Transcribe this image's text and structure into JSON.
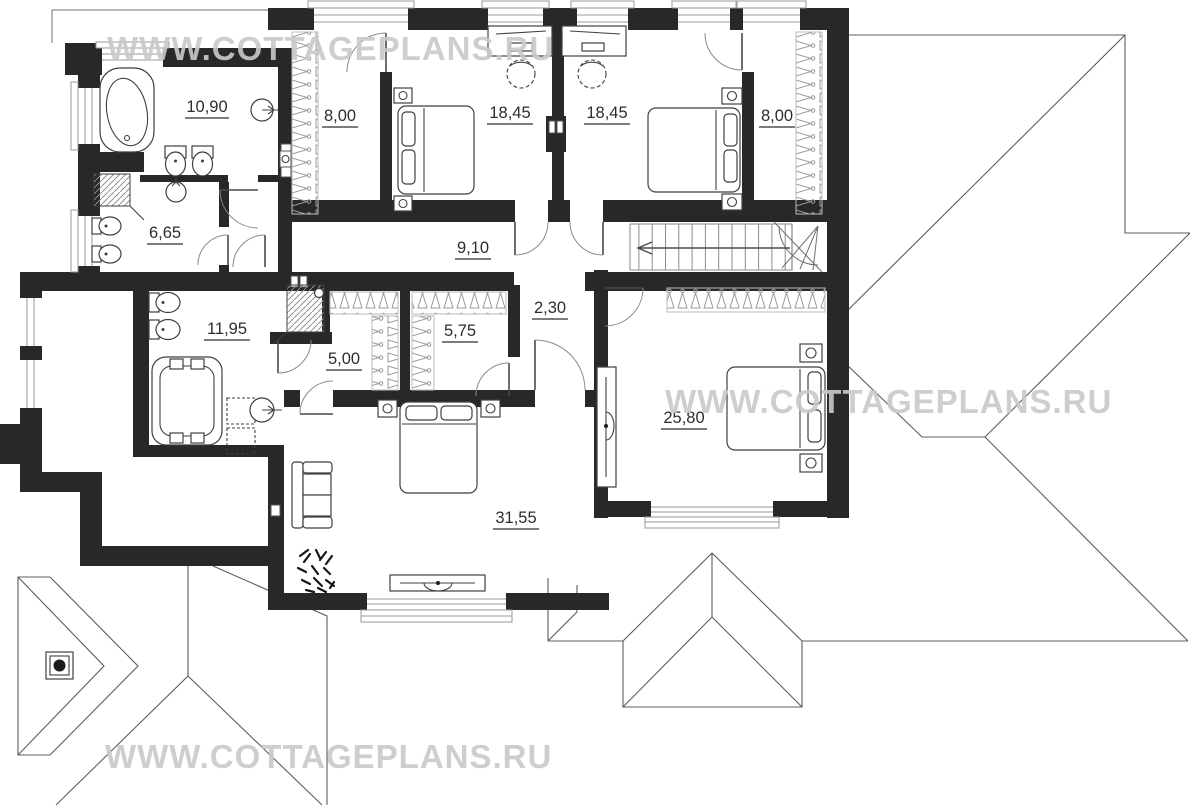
{
  "watermark": {
    "text": "WWW.COTTAGEPLANS.RU",
    "color": "#c9c9c9",
    "positions": [
      "top-left",
      "middle-right",
      "bottom-left"
    ]
  },
  "floor_plan": {
    "type": "second-floor cottage plan with roof outlines",
    "rooms": [
      {
        "id": "bathroom-top-left",
        "area_label": "10,90"
      },
      {
        "id": "wardrobe-left",
        "area_label": "8,00"
      },
      {
        "id": "bedroom-left",
        "area_label": "18,45"
      },
      {
        "id": "bedroom-center",
        "area_label": "18,45"
      },
      {
        "id": "wardrobe-right",
        "area_label": "8,00"
      },
      {
        "id": "toilet",
        "area_label": "6,65"
      },
      {
        "id": "hallway",
        "area_label": "9,10"
      },
      {
        "id": "master-bathroom",
        "area_label": "11,95"
      },
      {
        "id": "closet-left",
        "area_label": "5,00"
      },
      {
        "id": "closet-right",
        "area_label": "5,75"
      },
      {
        "id": "hall-passage",
        "area_label": "2,30"
      },
      {
        "id": "bedroom-right",
        "area_label": "25,80"
      },
      {
        "id": "master-bedroom",
        "area_label": "31,55"
      }
    ],
    "icons": [
      "corner-bathtub",
      "bidet",
      "toilet",
      "shower-cabin",
      "round-sink",
      "double-sink",
      "jacuzzi",
      "pedestal-sink",
      "bed",
      "nightstand",
      "desk",
      "chair",
      "hanger-rack",
      "sofa",
      "plant",
      "tv-stand",
      "stairs-arrow",
      "chimney",
      "vent-shaft"
    ],
    "colors": {
      "walls": "#282828",
      "roof_lines": "#5c5c5c",
      "watermark": "#c9c9c9"
    }
  }
}
